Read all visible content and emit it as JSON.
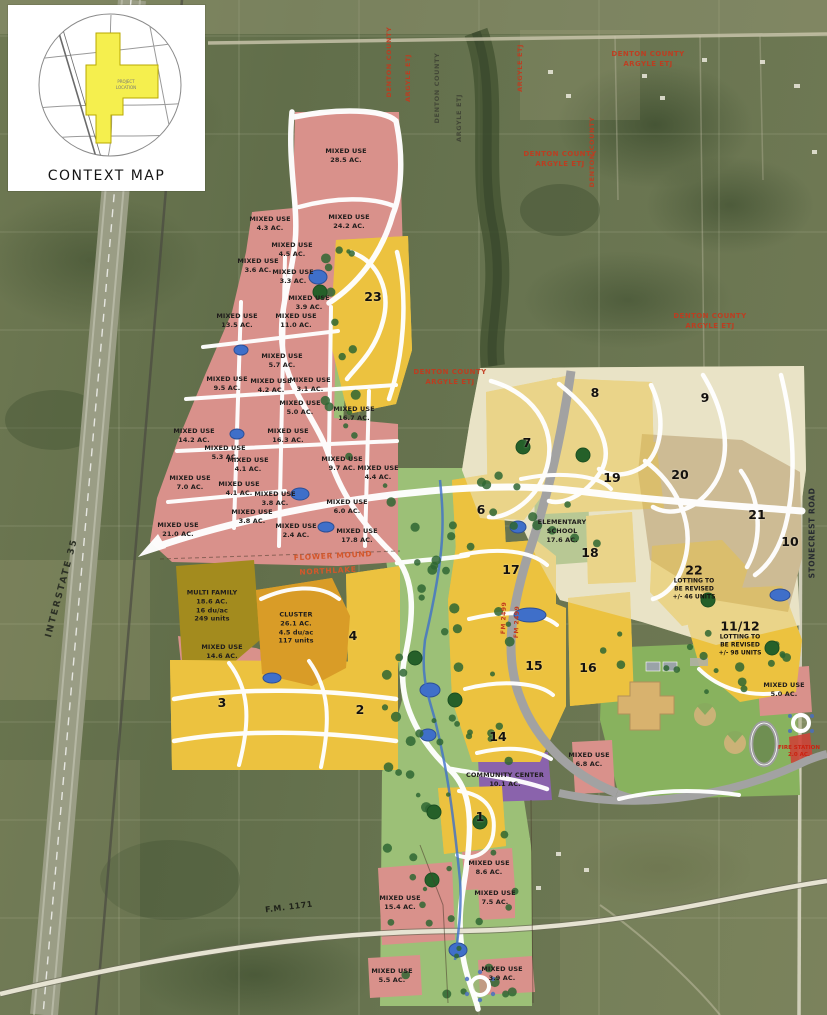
{
  "context_map": {
    "title": "CONTEXT MAP",
    "project_line1": "PROJECT",
    "project_line2": "LOCATION"
  },
  "road_labels": {
    "interstate": "INTERSTATE 35",
    "fm_1171": "F.M. 1171",
    "stonecrest": "STONECREST ROAD",
    "fm_2499": "FM 2499"
  },
  "jurisdiction": {
    "county": "DENTON COUNTY",
    "etj": "ARGYLE ETJ"
  },
  "boundary": {
    "flower_mound": "FLOWER MOUND",
    "northlake": "NORTHLAKE"
  },
  "palette": {
    "mixed_use": "#d9918b",
    "residential": "#ecc23f",
    "estate": "#e9e3c6",
    "large_lot": "#cdbb94",
    "cluster": "#d99c27",
    "multi_family": "#a38b1e",
    "open_space": "#9cc077",
    "school": "#7ca757",
    "community_center": "#8a63ac",
    "water": "#3f6fc9"
  },
  "mixed_use": [
    {
      "use": "MIXED USE",
      "area": "28.5 AC."
    },
    {
      "use": "MIXED USE",
      "area": "24.2 AC."
    },
    {
      "use": "MIXED USE",
      "area": "4.3 AC."
    },
    {
      "use": "MIXED USE",
      "area": "4.5 AC."
    },
    {
      "use": "MIXED USE",
      "area": "3.6 AC."
    },
    {
      "use": "MIXED USE",
      "area": "3.3 AC."
    },
    {
      "use": "MIXED USE",
      "area": "3.9 AC."
    },
    {
      "use": "MIXED USE",
      "area": "13.5 AC."
    },
    {
      "use": "MIXED USE",
      "area": "11.0 AC."
    },
    {
      "use": "MIXED USE",
      "area": "5.7 AC."
    },
    {
      "use": "MIXED USE",
      "area": "9.5 AC."
    },
    {
      "use": "MIXED USE",
      "area": "4.2 AC."
    },
    {
      "use": "MIXED USE",
      "area": "3.1 AC."
    },
    {
      "use": "MIXED USE",
      "area": "5.0 AC."
    },
    {
      "use": "MIXED USE",
      "area": "16.7 AC."
    },
    {
      "use": "MIXED USE",
      "area": "14.2 AC."
    },
    {
      "use": "MIXED USE",
      "area": "16.3 AC."
    },
    {
      "use": "MIXED USE",
      "area": "5.3 AC."
    },
    {
      "use": "MIXED USE",
      "area": "4.1 AC."
    },
    {
      "use": "MIXED USE",
      "area": "9.7 AC."
    },
    {
      "use": "MIXED USE",
      "area": "4.4 AC."
    },
    {
      "use": "MIXED USE",
      "area": "7.0 AC."
    },
    {
      "use": "MIXED USE",
      "area": "4.1 AC."
    },
    {
      "use": "MIXED USE",
      "area": "3.8 AC."
    },
    {
      "use": "MIXED USE",
      "area": "6.0 AC."
    },
    {
      "use": "MIXED USE",
      "area": "3.8 AC."
    },
    {
      "use": "MIXED USE",
      "area": "21.0 AC."
    },
    {
      "use": "MIXED USE",
      "area": "2.4 AC."
    },
    {
      "use": "MIXED USE",
      "area": "17.8 AC."
    },
    {
      "use": "MIXED USE",
      "area": "14.6 AC."
    },
    {
      "use": "MIXED USE",
      "area": "6.8 AC."
    },
    {
      "use": "MIXED USE",
      "area": "5.0 AC."
    },
    {
      "use": "MIXED USE",
      "area": "8.6 AC."
    },
    {
      "use": "MIXED USE",
      "area": "7.5 AC."
    },
    {
      "use": "MIXED USE",
      "area": "15.4 AC."
    },
    {
      "use": "MIXED USE",
      "area": "5.5 AC."
    },
    {
      "use": "MIXED USE",
      "area": "3.9 AC."
    }
  ],
  "multi_family": {
    "name": "MULTI FAMILY",
    "area": "18.6 AC.",
    "density": "16 du/ac",
    "units": "249 units"
  },
  "cluster": {
    "name": "CLUSTER",
    "area": "26.1 AC.",
    "density": "4.5 du/ac",
    "units": "117 units"
  },
  "elementary_school": {
    "name1": "ELEMENTARY",
    "name2": "SCHOOL",
    "area": "17.6 AC."
  },
  "community_center": {
    "name": "COMMUNITY CENTER",
    "area": "10.1 AC."
  },
  "fire_station": {
    "name": "FIRE STATION",
    "area": "2.0 AC."
  },
  "notes": {
    "n22": {
      "num": "22",
      "l1": "LOTTING TO",
      "l2": "BE REVISED",
      "l3": "+/- 46 UNITS"
    },
    "n11_12": {
      "num": "11/12",
      "l1": "LOTTING TO",
      "l2": "BE REVISED",
      "l3": "+/- 98 UNITS"
    }
  },
  "phases": {
    "p1": "1",
    "p2": "2",
    "p3": "3",
    "p4": "4",
    "p6": "6",
    "p7": "7",
    "p8": "8",
    "p9": "9",
    "p10": "10",
    "p14": "14",
    "p15": "15",
    "p16": "16",
    "p17": "17",
    "p18": "18",
    "p19": "19",
    "p20": "20",
    "p21": "21",
    "p23": "23"
  }
}
